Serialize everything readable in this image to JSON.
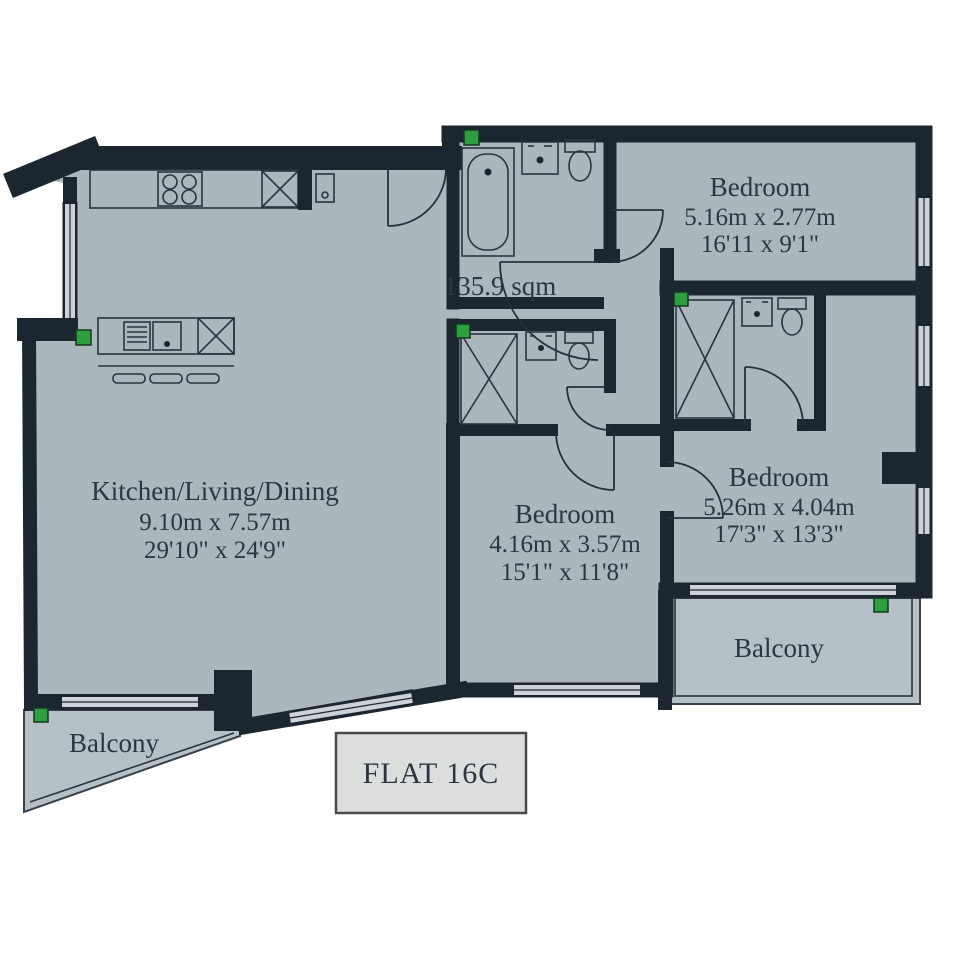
{
  "colors": {
    "wall": "#1b2630",
    "floor": "#abb6bd",
    "balcony_floor": "#b6c0c7",
    "text": "#2c3542",
    "vent_green": "#2f9e41",
    "flat_box_fill": "#dcdddd",
    "background": "#ffffff"
  },
  "plan": {
    "flat_label": "FLAT 16C",
    "area_label": "135.9 sqm",
    "rooms": {
      "kitchen": {
        "name": "Kitchen/Living/Dining",
        "metric": "9.10m x 7.57m",
        "imperial": "29'10\" x 24'9\""
      },
      "bedroom_top": {
        "name": "Bedroom",
        "metric": "5.16m x 2.77m",
        "imperial": "16'11 x 9'1\""
      },
      "bedroom_middle": {
        "name": "Bedroom",
        "metric": "4.16m x 3.57m",
        "imperial": "15'1\" x 11'8\""
      },
      "bedroom_right": {
        "name": "Bedroom",
        "metric": "5.26m x 4.04m",
        "imperial": "17'3\" x 13'3\""
      },
      "balcony_left": {
        "name": "Balcony"
      },
      "balcony_right": {
        "name": "Balcony"
      }
    }
  }
}
